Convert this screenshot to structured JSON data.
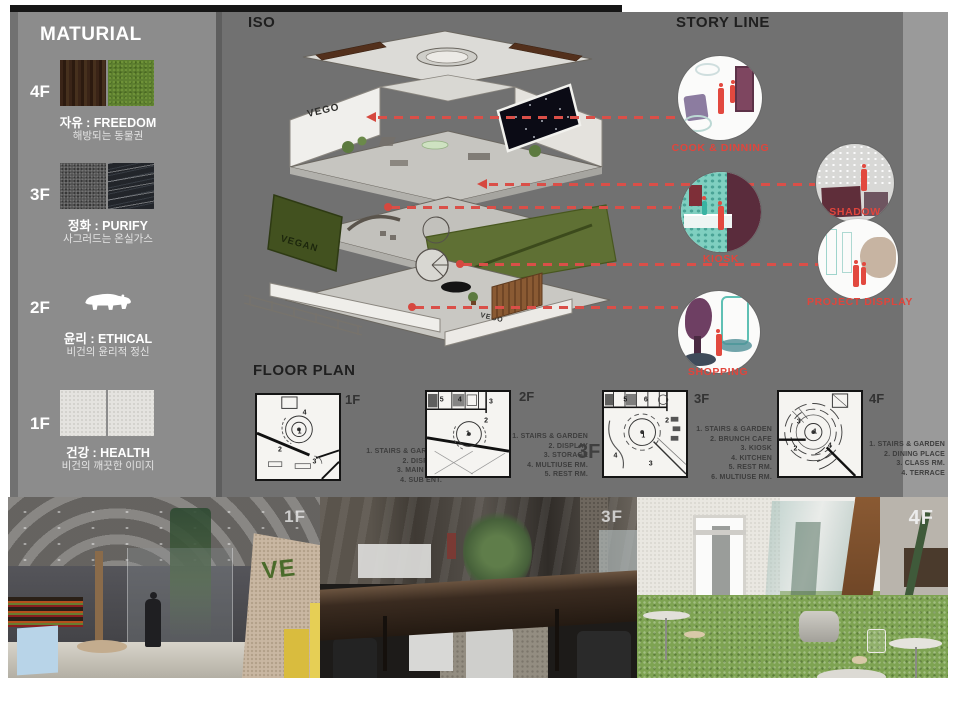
{
  "colors": {
    "accent_red": "#da4f48",
    "board_gray": "#717171",
    "sidebar_gray": "#8c8c8c",
    "legend_text": "#3d3d3d"
  },
  "sidebar": {
    "title": "MATURIAL",
    "floors": [
      {
        "tag": "4F",
        "title": "자유 : FREEDOM",
        "subtitle": "해방되는 동물권"
      },
      {
        "tag": "3F",
        "title": "정화 : PURIFY",
        "subtitle": "사그러드는 온실가스"
      },
      {
        "tag": "2F",
        "title": "윤리 : ETHICAL",
        "subtitle": "비건의 윤리적 정신"
      },
      {
        "tag": "1F",
        "title": "건강 : HEALTH",
        "subtitle": "비건의 깨끗한 이미지"
      }
    ]
  },
  "iso": {
    "title": "ISO",
    "wall_sign": "VEGO",
    "wall_sign_2": "VEGO",
    "moss_sign": "VEGAN"
  },
  "storyline": {
    "title": "STORY LINE",
    "items": [
      {
        "label": "COOK & DINNING"
      },
      {
        "label": "SHADOW"
      },
      {
        "label": "KIOSK"
      },
      {
        "label": "PROJECT DISPLAY"
      },
      {
        "label": "SHOPPING"
      }
    ]
  },
  "floorplan": {
    "title": "FLOOR PLAN",
    "section_tag": "3F",
    "plans": [
      {
        "tag": "1F",
        "rooms": [
          "1",
          "2",
          "3",
          "4"
        ],
        "legend": [
          "1. STAIRS & GARDEN",
          "2. DISPLAY",
          "3. MAIN ENT.",
          "4. SUB ENT."
        ]
      },
      {
        "tag": "2F",
        "rooms": [
          "1",
          "2",
          "3",
          "4",
          "5"
        ],
        "legend": [
          "1. STAIRS & GARDEN",
          "2. DISPLAY",
          "3. STORAGE",
          "4. MULTIUSE RM.",
          "5. REST RM."
        ]
      },
      {
        "tag": "3F",
        "rooms": [
          "1",
          "2",
          "3",
          "4",
          "5",
          "6"
        ],
        "legend": [
          "1. STAIRS & GARDEN",
          "2. BRUNCH CAFE",
          "3. KIOSK",
          "4. KITCHEN",
          "5. REST RM.",
          "6. MULTIUSE RM."
        ]
      },
      {
        "tag": "4F",
        "rooms": [
          "1",
          "2",
          "3",
          "4"
        ],
        "legend": [
          "1. STAIRS & GARDEN",
          "2. DINING PLACE",
          "3. CLASS RM.",
          "4. TERRACE"
        ]
      }
    ]
  },
  "renders": [
    {
      "tag": "1F",
      "sign": "VE"
    },
    {
      "tag": "3F"
    },
    {
      "tag": "4F"
    }
  ]
}
